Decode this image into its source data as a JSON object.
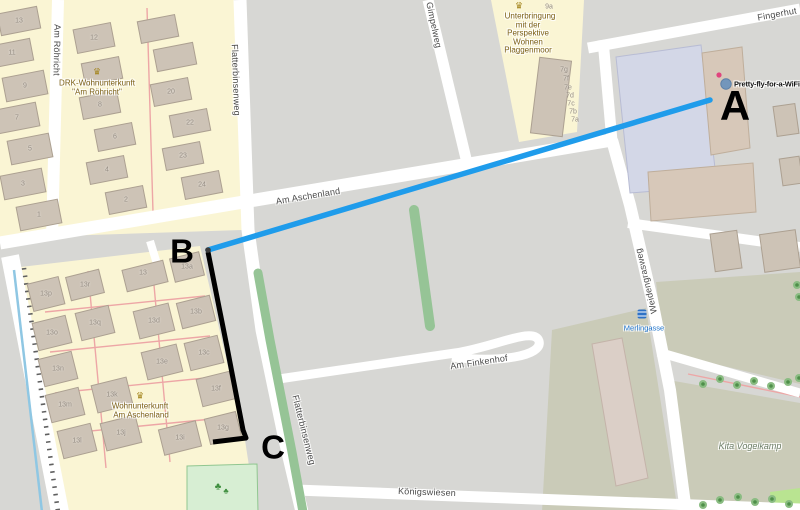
{
  "map": {
    "streets": {
      "am_roehricht": "Am Röhricht",
      "flatterbinsenweg": "Flatterbinsenweg",
      "am_aschenland": "Am Aschenland",
      "gimpelweg": "Gimpelweg",
      "fingerhut": "Fingerhut",
      "weidengrasweg": "Weidengrasweg",
      "am_finkenhof": "Am Finkenhof",
      "koenigswiesen": "Königswiesen"
    },
    "places": {
      "drk": {
        "line1": "DRK-Wohnunterkunft",
        "line2": "\"Am Röhricht\""
      },
      "aschenland": {
        "line1": "Wohnunterkunft",
        "line2": "Am Aschenland"
      },
      "plaggenmoor": {
        "line1": "Unterbringung",
        "line2": "mit der",
        "line3": "Perspektive",
        "line4": "Wohnen",
        "line5": "Plaggenmoor"
      },
      "kita": {
        "name": "Kita Vogelkamp"
      }
    },
    "transit": {
      "stop_name": "Merlingasse"
    },
    "colors": {
      "background": "#d7d7d4",
      "road": "#ffffff",
      "residential": "#faf5d4",
      "building": "#cdc3b6",
      "building_outline": "#aca091",
      "khaki": "#cacbb8",
      "park": "#d7eed3",
      "grass_strip": "#96c496",
      "hedge_pink": "#eda6a6",
      "cycleway_blue": "#8fc7e3",
      "transit_blue": "#1a70c9",
      "poi_brown": "#7a5e14"
    },
    "housenumbers": [
      {
        "t": "13",
        "x": 19,
        "y": 21
      },
      {
        "t": "11",
        "x": 12,
        "y": 53
      },
      {
        "t": "9",
        "x": 25,
        "y": 86
      },
      {
        "t": "7",
        "x": 17,
        "y": 118
      },
      {
        "t": "5",
        "x": 30,
        "y": 149
      },
      {
        "t": "3",
        "x": 23,
        "y": 184
      },
      {
        "t": "1",
        "x": 39,
        "y": 215
      },
      {
        "t": "12",
        "x": 94,
        "y": 38
      },
      {
        "t": "8",
        "x": 100,
        "y": 105
      },
      {
        "t": "6",
        "x": 115,
        "y": 137
      },
      {
        "t": "4",
        "x": 107,
        "y": 170
      },
      {
        "t": "2",
        "x": 126,
        "y": 200
      },
      {
        "t": "20",
        "x": 171,
        "y": 92
      },
      {
        "t": "22",
        "x": 190,
        "y": 123
      },
      {
        "t": "23",
        "x": 183,
        "y": 156
      },
      {
        "t": "24",
        "x": 202,
        "y": 185
      },
      {
        "t": "13p",
        "x": 46,
        "y": 294
      },
      {
        "t": "13r",
        "x": 85,
        "y": 285
      },
      {
        "t": "13",
        "x": 143,
        "y": 273
      },
      {
        "t": "13a",
        "x": 187,
        "y": 267
      },
      {
        "t": "13o",
        "x": 52,
        "y": 333
      },
      {
        "t": "13q",
        "x": 95,
        "y": 323
      },
      {
        "t": "13d",
        "x": 154,
        "y": 321
      },
      {
        "t": "13b",
        "x": 196,
        "y": 312
      },
      {
        "t": "13n",
        "x": 58,
        "y": 369
      },
      {
        "t": "13e",
        "x": 162,
        "y": 362
      },
      {
        "t": "13c",
        "x": 204,
        "y": 353
      },
      {
        "t": "13m",
        "x": 65,
        "y": 405
      },
      {
        "t": "13k",
        "x": 112,
        "y": 395
      },
      {
        "t": "13f",
        "x": 216,
        "y": 389
      },
      {
        "t": "13l",
        "x": 77,
        "y": 441
      },
      {
        "t": "13j",
        "x": 121,
        "y": 433
      },
      {
        "t": "13i",
        "x": 180,
        "y": 438
      },
      {
        "t": "13g",
        "x": 223,
        "y": 428
      },
      {
        "t": "9a",
        "x": 549,
        "y": 7
      },
      {
        "t": "7g",
        "x": 564,
        "y": 70
      },
      {
        "t": "7f",
        "x": 566,
        "y": 79
      },
      {
        "t": "7e",
        "x": 568,
        "y": 88
      },
      {
        "t": "7d",
        "x": 570,
        "y": 96
      },
      {
        "t": "7c",
        "x": 571,
        "y": 104
      },
      {
        "t": "7b",
        "x": 573,
        "y": 112
      },
      {
        "t": "7a",
        "x": 575,
        "y": 120
      }
    ],
    "buildings": [
      {
        "x": 19,
        "y": 21,
        "w": 40,
        "h": 22,
        "r": -11
      },
      {
        "x": 12,
        "y": 53,
        "w": 40,
        "h": 22,
        "r": -11
      },
      {
        "x": 25,
        "y": 86,
        "w": 42,
        "h": 24,
        "r": -11
      },
      {
        "x": 17,
        "y": 118,
        "w": 42,
        "h": 24,
        "r": -11
      },
      {
        "x": 30,
        "y": 149,
        "w": 42,
        "h": 24,
        "r": -11
      },
      {
        "x": 23,
        "y": 184,
        "w": 42,
        "h": 24,
        "r": -11
      },
      {
        "x": 39,
        "y": 215,
        "w": 42,
        "h": 24,
        "r": -11
      },
      {
        "x": 94,
        "y": 38,
        "w": 38,
        "h": 24,
        "r": -11
      },
      {
        "x": 102,
        "y": 71,
        "w": 38,
        "h": 22,
        "r": -11
      },
      {
        "x": 100,
        "y": 105,
        "w": 38,
        "h": 22,
        "r": -11
      },
      {
        "x": 115,
        "y": 137,
        "w": 38,
        "h": 22,
        "r": -11
      },
      {
        "x": 107,
        "y": 170,
        "w": 38,
        "h": 22,
        "r": -11
      },
      {
        "x": 126,
        "y": 200,
        "w": 38,
        "h": 22,
        "r": -11
      },
      {
        "x": 158,
        "y": 29,
        "w": 38,
        "h": 22,
        "r": -11
      },
      {
        "x": 175,
        "y": 57,
        "w": 40,
        "h": 22,
        "r": -11
      },
      {
        "x": 171,
        "y": 92,
        "w": 38,
        "h": 22,
        "r": -11
      },
      {
        "x": 190,
        "y": 123,
        "w": 38,
        "h": 22,
        "r": -11
      },
      {
        "x": 183,
        "y": 156,
        "w": 38,
        "h": 22,
        "r": -11
      },
      {
        "x": 202,
        "y": 185,
        "w": 38,
        "h": 22,
        "r": -11
      },
      {
        "x": 46,
        "y": 294,
        "w": 32,
        "h": 28,
        "r": -14
      },
      {
        "x": 85,
        "y": 285,
        "w": 34,
        "h": 24,
        "r": -14
      },
      {
        "x": 145,
        "y": 276,
        "w": 42,
        "h": 22,
        "r": -14
      },
      {
        "x": 187,
        "y": 267,
        "w": 30,
        "h": 24,
        "r": -14
      },
      {
        "x": 52,
        "y": 333,
        "w": 34,
        "h": 28,
        "r": -14
      },
      {
        "x": 95,
        "y": 323,
        "w": 34,
        "h": 28,
        "r": -14
      },
      {
        "x": 154,
        "y": 321,
        "w": 36,
        "h": 28,
        "r": -14
      },
      {
        "x": 196,
        "y": 312,
        "w": 34,
        "h": 26,
        "r": -14
      },
      {
        "x": 58,
        "y": 369,
        "w": 34,
        "h": 28,
        "r": -14
      },
      {
        "x": 162,
        "y": 362,
        "w": 36,
        "h": 28,
        "r": -14
      },
      {
        "x": 204,
        "y": 353,
        "w": 34,
        "h": 28,
        "r": -14
      },
      {
        "x": 65,
        "y": 405,
        "w": 34,
        "h": 28,
        "r": -14
      },
      {
        "x": 112,
        "y": 395,
        "w": 36,
        "h": 28,
        "r": -14
      },
      {
        "x": 216,
        "y": 389,
        "w": 34,
        "h": 28,
        "r": -14
      },
      {
        "x": 77,
        "y": 441,
        "w": 34,
        "h": 28,
        "r": -14
      },
      {
        "x": 121,
        "y": 433,
        "w": 36,
        "h": 28,
        "r": -14
      },
      {
        "x": 180,
        "y": 438,
        "w": 38,
        "h": 26,
        "r": -14
      },
      {
        "x": 223,
        "y": 428,
        "w": 32,
        "h": 26,
        "r": -14
      },
      {
        "x": 551,
        "y": 97,
        "w": 32,
        "h": 76,
        "r": 7
      },
      {
        "x": 786,
        "y": 120,
        "w": 22,
        "h": 30,
        "r": -8
      },
      {
        "x": 791,
        "y": 171,
        "w": 20,
        "h": 27,
        "r": -8
      },
      {
        "x": 726,
        "y": 251,
        "w": 27,
        "h": 38,
        "r": -8
      },
      {
        "x": 780,
        "y": 251,
        "w": 36,
        "h": 38,
        "r": -8
      },
      {
        "poly": "616,57 701,45 717,186 630,193",
        "fill": "#d3d7e7",
        "stroke": "#b8bcd4"
      },
      {
        "poly": "702,53 742,47 750,148 711,155",
        "fill": "#d7c8b9",
        "stroke": "#bfae9b"
      },
      {
        "poly": "648,172 753,163 756,212 651,221",
        "fill": "#d7c8b9",
        "stroke": "#bfae9b"
      },
      {
        "poly": "592,344 622,338 648,478 616,486",
        "fill": "#dbcfc7",
        "stroke": "#c4b3a9"
      }
    ],
    "pink_paths": [
      "M45,312 L205,296",
      "M50,352 L210,336",
      "M55,393 L215,377",
      "M60,434 L222,418",
      "M88,271 L106,468",
      "M152,263 L170,462",
      "M688,374 L800,397",
      "M700,501 L800,508",
      "M147,8 L153,212"
    ],
    "trees": [
      [
        703,
        384
      ],
      [
        720,
        379
      ],
      [
        737,
        385
      ],
      [
        754,
        381
      ],
      [
        771,
        386
      ],
      [
        788,
        382
      ],
      [
        799,
        378
      ],
      [
        703,
        505
      ],
      [
        720,
        500
      ],
      [
        738,
        497
      ],
      [
        755,
        502
      ],
      [
        772,
        499
      ],
      [
        789,
        504
      ],
      [
        797,
        285
      ],
      [
        799,
        297
      ]
    ]
  },
  "annotation": {
    "points": [
      {
        "label": "A",
        "x": 735,
        "y": 106
      },
      {
        "label": "B",
        "x": 182,
        "y": 251
      },
      {
        "label": "C",
        "x": 273,
        "y": 447
      }
    ],
    "blue_line": {
      "from": [
        208,
        250
      ],
      "to": [
        710,
        100
      ],
      "color": "#1f9ceb"
    },
    "black_path": {
      "points": [
        [
          208,
          252
        ],
        [
          227,
          347
        ],
        [
          243,
          430
        ],
        [
          246,
          438
        ],
        [
          213,
          442
        ]
      ],
      "color": "#000000"
    },
    "wifi_marker": {
      "label": "Pretty-fly-for-a-WiFi",
      "x": 726,
      "y": 84
    }
  }
}
